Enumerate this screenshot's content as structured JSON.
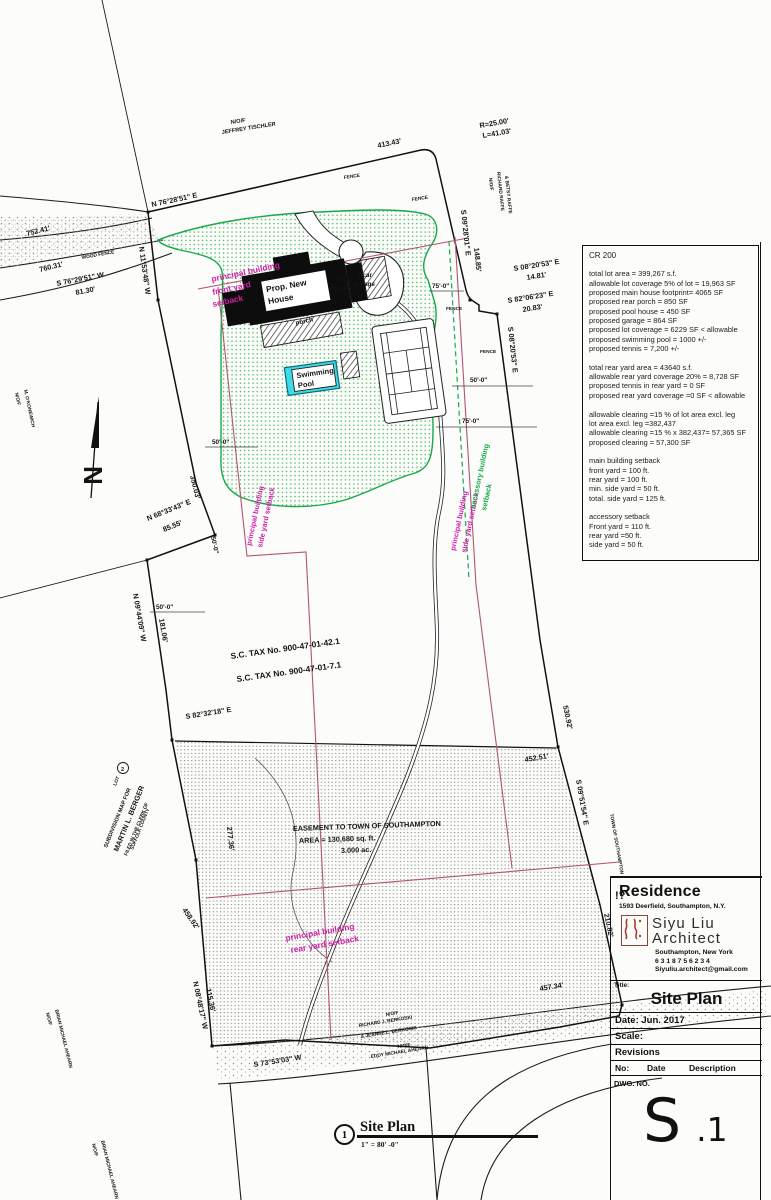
{
  "colors": {
    "green": "#18a84b",
    "magenta": "#cf1fa6",
    "setback_line": "#b0566f",
    "pool_cyan": "#3fd9e8"
  },
  "notes": {
    "title": "CR 200",
    "lines": [
      "total lot area = 399,267 s.f.",
      "allowable lot coverage 5% of lot = 19,963 SF",
      "proposed main house footprint= 4065 SF",
      "proposed rear porch = 850 SF",
      "proposed pool house = 450 SF",
      "proposed garage = 864 SF",
      "proposed lot coverage = 6229 SF < allowable",
      "proposed swimming pool = 1000 +/-",
      "proposed tennis = 7,200 +/-",
      "",
      "total rear yard area = 43640 s.f.",
      "allowable rear yard coverage 20% = 8,728 SF",
      "proposed tennis in rear yard = 0 SF",
      "proposed rear yard coverage =0 SF < allowable",
      "",
      "allowable clearing =15 % of lot area excl. leg",
      "lot area excl. leg =382,437",
      "allowable clearing =15 % x 382,437= 57,365 SF",
      "proposed clearing = 57,300 SF",
      "",
      "main building setback",
      "front yard = 100 ft.",
      "rear yard = 100 ft.",
      "min. side yard = 50 ft.",
      "total. side yard = 125 ft.",
      "",
      "accessory setback",
      "Front yard = 110 ft.",
      "rear yard =50 ft.",
      "side yard = 50 ft."
    ]
  },
  "title_block": {
    "project": "Residence",
    "address": "1593 Deerfield, Southampton,  N.Y.",
    "name1": "Siyu Liu",
    "name2": "Architect",
    "city": "Southampton, New York",
    "phone": "6 3 1  8 7 5  6 2 3 4",
    "email": "Siyuliu.architect@gmail.com",
    "title_label": "Title:",
    "sheet_title": "Site Plan",
    "date": "Date: Jun. 2017",
    "scale": "Scale:",
    "revisions": "Revisions",
    "rev_no": "No:",
    "rev_date": "Date",
    "rev_desc": "Description",
    "dwg": "DWG. NO.",
    "s_main": "S",
    "s_sub": ".1"
  },
  "footer": {
    "detail_no": "1",
    "detail_title": "Site Plan",
    "detail_scale": "1\" = 80' -0\""
  },
  "plan": {
    "north_letter": "N",
    "owners": {
      "prefix": "N/O/F",
      "tischler": "JEFFREY TISCHLER",
      "raffe1": "RICHARD RAFFE",
      "raffe2": "& BETSY RAFFE",
      "konewich": "M. O'KONEWICH",
      "berkoski1": "RICHARD J. BERKOSKI",
      "berkoski2": "& JEANNE L. BERKOSKI",
      "ahearn": "BRIAN MICHAEL AHEARN",
      "ahearn2": "EDDY MICHAEL AHEARN",
      "town": "TOWN OF SOUTHAMPTON"
    },
    "bearings": {
      "top_bearing": "N 76°28'51\" E",
      "top_dist": "413.43'",
      "curve_r": "R=25.00'",
      "curve_l": "L=41.03'",
      "e1": "S 09°28'01\" E",
      "e1_dist": "148.85'",
      "e2": "S 08°20'53\" E",
      "e2_dist": "14.81'",
      "e3": "S 82°06'23\" E",
      "e3_dist": "20.83'",
      "e4": "S 08°20'53\" E",
      "road_d1": "752.41'",
      "road_d2": "760.31'",
      "sw_bearing": "S 76°29'51\" W",
      "sw_dist": "81.30'",
      "w1": "N 11°53'48\" W",
      "w2_dist": "350.03'",
      "w3": "N 68°33'43\" E",
      "w3_dist": "85.55'",
      "w4": "N 09°44'09\" W",
      "w4_dist": "181.06'",
      "ease_bearing": "S 82°32'18\" E",
      "d452": "452.51'",
      "d530": "530.92'",
      "se": "S 09°51'54\" E",
      "d277": "277.36'",
      "d458": "458.92'",
      "d210": "210.82'",
      "d457": "457.34'",
      "s_bearing": "S 73°53'03\" W",
      "sw2": "N 08°48'17\" W",
      "sw2_dist": "115.36'"
    },
    "tax": {
      "t1": "S.C. TAX No. 900-47-01-42.1",
      "t2": "S.C. TAX No. 900-47-01-7.1"
    },
    "easement": {
      "l1": "EASEMENT TO TOWN OF SOUTHAMPTON",
      "l2": "AREA = 130,680 sq. ft.",
      "l3": "3.000 ac."
    },
    "setbacks": {
      "pb": "principal building",
      "front": "front yard",
      "setback": "setback",
      "side": "side yard setback",
      "acc": "accessory building",
      "rear": "rear yard setback"
    },
    "house": {
      "l1": "Prop. New",
      "l2": "House",
      "porch": "porch",
      "porte1": "porte",
      "porte2": "cochere",
      "garage1": "3 car",
      "garage2": "garage"
    },
    "pool": {
      "l1": "Swimming",
      "l2": "Pool"
    },
    "subdivision": {
      "l1": "SUBDIVISION MAP FOR",
      "l2": "MARTIN L. BERGER",
      "l3": "FILED IN THE CLERK OF",
      "l4": "SUFFOLK COUNTY",
      "lot": "LOT",
      "lot_no": "2"
    },
    "dims": {
      "d50": "50'-0\"",
      "d75": "75'-0\""
    },
    "misc": {
      "wood_fence": "WOOD FENCE",
      "fence": "FENCE",
      "edge_note": "!?"
    }
  }
}
